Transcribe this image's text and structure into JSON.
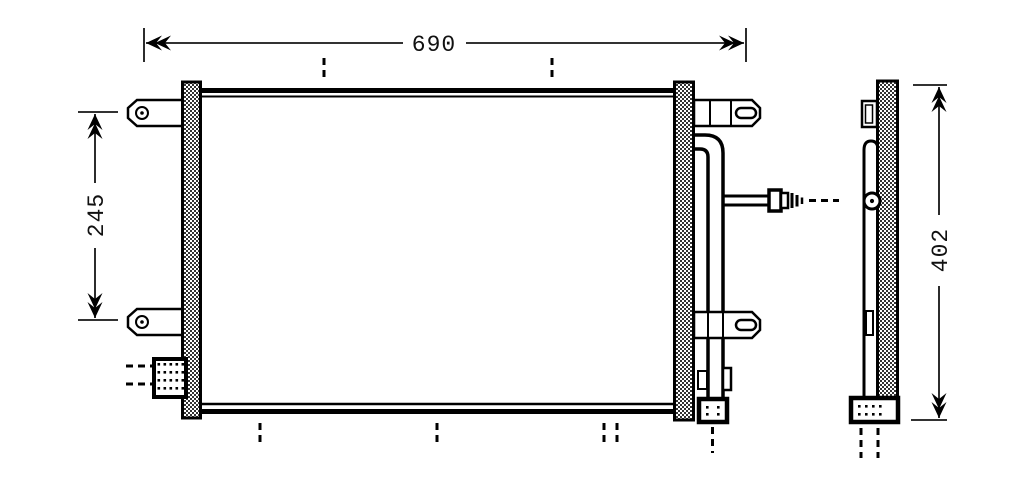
{
  "drawing": {
    "kind": "condenser-technical-drawing",
    "colors": {
      "line": "#000000",
      "background": "#ffffff",
      "hatch": "#000000"
    },
    "dimensions": {
      "top_width": "690",
      "left_tab_spacing": "245",
      "side_height": "402"
    }
  }
}
